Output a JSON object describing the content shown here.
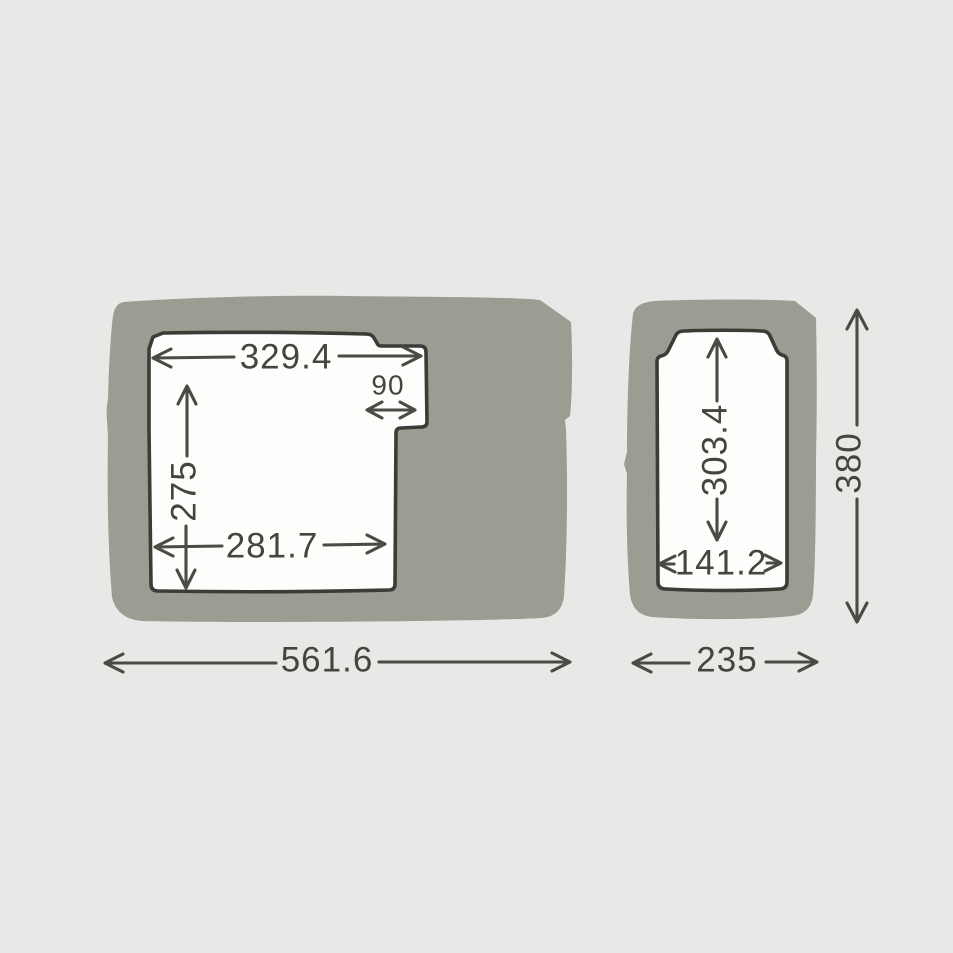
{
  "diagram": {
    "type": "dimension-drawing",
    "units_shown": false,
    "colors": {
      "background": "#e8e8e6",
      "body_fill": "#9a9d91",
      "compartment_fill": "#fdfdfc",
      "outline": "#3c3c36",
      "dimension_lines": "#4b4b44"
    },
    "left_figure": {
      "inner_top_width": "329.4",
      "notch_width": "90",
      "inner_height": "275",
      "inner_bottom_width": "281.7",
      "overall_width": "561.6"
    },
    "right_figure": {
      "inner_height": "303.4",
      "inner_width": "141.2",
      "overall_height": "380",
      "overall_width": "235"
    }
  }
}
